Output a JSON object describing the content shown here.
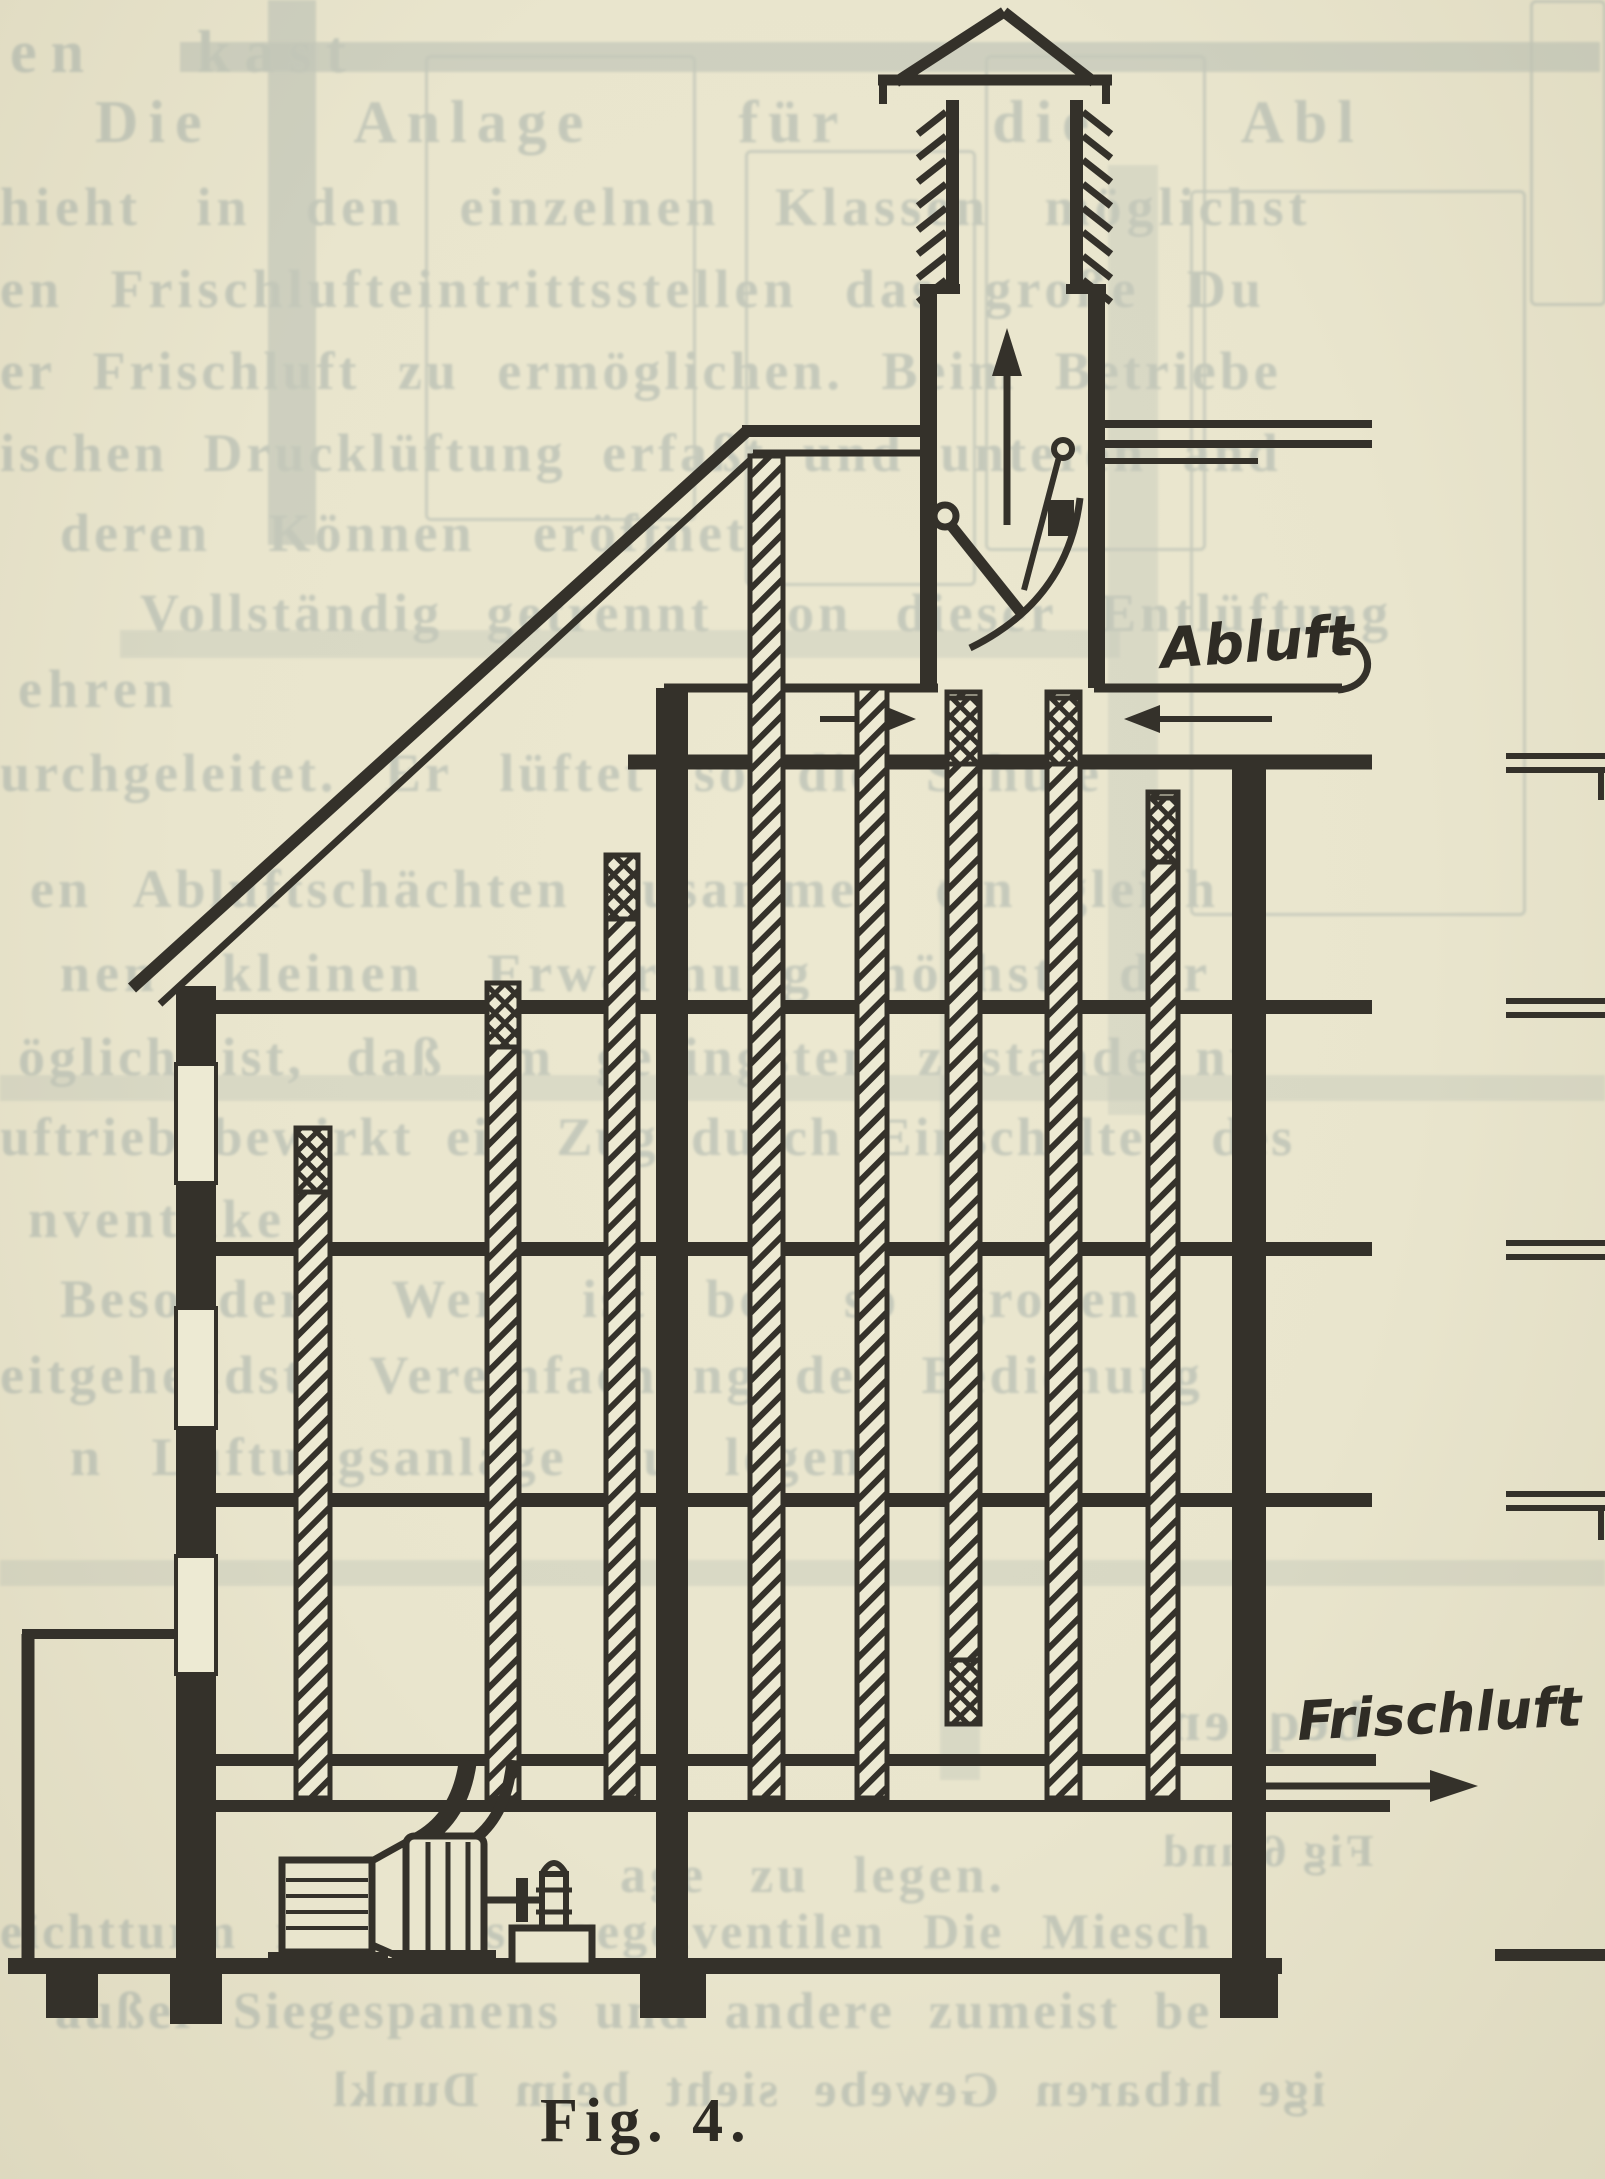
{
  "figure": {
    "caption": "Fig. 4.",
    "label_abluft": "Abluft",
    "label_frischluft": "Frischluft"
  },
  "colors": {
    "paper": "#e9e5cd",
    "ink": "#34312a",
    "bleedthrough": "#71878f"
  },
  "bleedthrough": {
    "lines": [
      "en kast",
      "Die Anlage für die Abl",
      "hieht in den einzelnen Klassen möglichst",
      "en Frischlufteintrittsstellen das große Du",
      "er Frischluft zu ermöglichen. Beim Betriebe",
      "ischen Drucklüftung erfaßt und unteren and",
      "deren Können eröffnet.",
      "Vollständig getrennt von dieser Entlüftung",
      "ehren",
      "urchgeleitet. Er lüftet so die Schule",
      "en Abluftschächten zusammen ein gleich",
      "nen kleinen Erwärmung höchst der",
      "öglich ist, daß im geringsten zustande nu",
      "uftrieb bewirkt ein Zug durch Einschalten des",
      "nventilke",
      "Besondere Wert ist bei so großen",
      "eitgehendste Vereinfachung der Bedienung",
      "n Lüftungsanlage zu legen.",
      "age zu legen.",
      "eichtturm mit Drosselregelventilen   Die Miesch",
      "außer Siegespanens und andere zumeist be",
      "ige htbaren Gewebe sieht beim Dunkl",
      "bequem",
      "Fig 6 und"
    ]
  }
}
